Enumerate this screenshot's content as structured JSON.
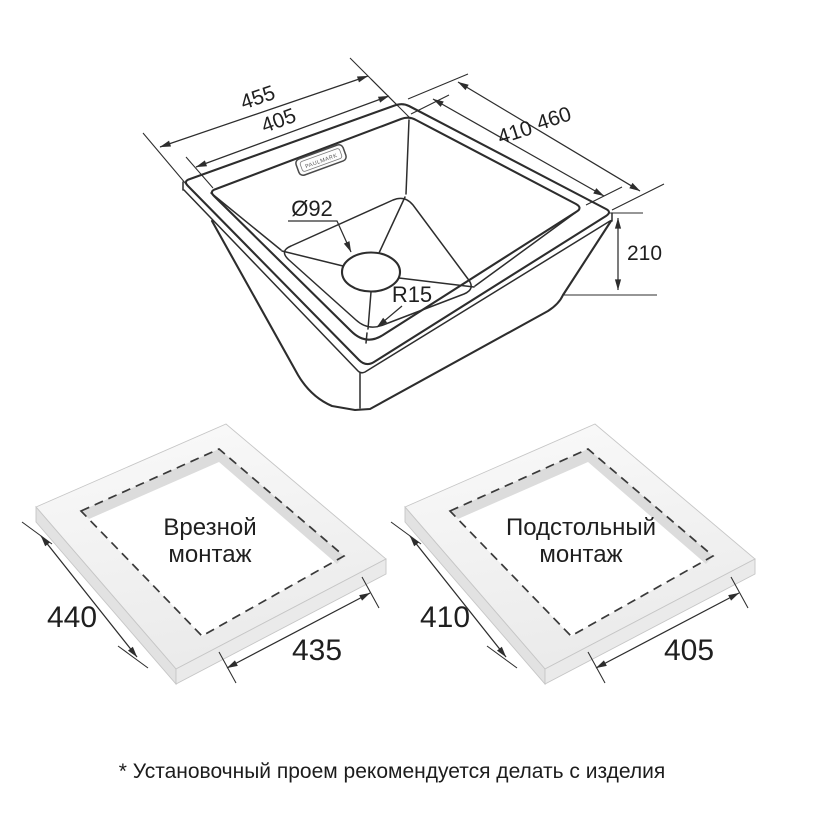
{
  "sink_drawing": {
    "dim_outer_width": "455",
    "dim_inner_width": "405",
    "dim_outer_depth": "460",
    "dim_inner_depth": "410",
    "dim_height": "210",
    "dim_drain": "Ø92",
    "dim_corner_radius": "R15",
    "brand_plate": "PAULMARK"
  },
  "mount_left": {
    "title_line1": "Врезной",
    "title_line2": "монтаж",
    "dim_side": "440",
    "dim_front": "435"
  },
  "mount_right": {
    "title_line1": "Подстольный",
    "title_line2": "монтаж",
    "dim_side": "410",
    "dim_front": "405"
  },
  "footnote": "* Установочный проем рекомендуется делать с изделия",
  "colors": {
    "line": "#2d2d2d",
    "dashed_cutout": "#3a3a3a",
    "slab_top": "#f1f1f1",
    "slab_side": "#e4e4e4",
    "cutout_wall": "#dcdcdc",
    "background": "#ffffff"
  }
}
